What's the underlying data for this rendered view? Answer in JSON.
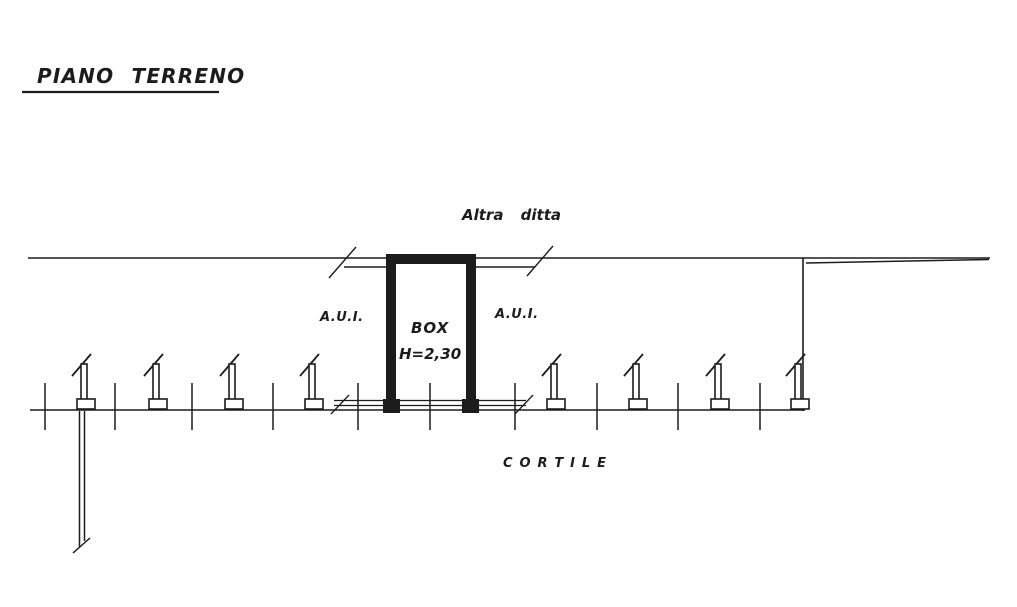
{
  "colors": {
    "ink": "#1c1c1c",
    "paper": "#ffffff"
  },
  "plan": {
    "title": "PIANO TERRENO",
    "labels": {
      "altra_ditta": "Altra ditta",
      "aui_left": "A.U.I.",
      "aui_right": "A.U.I.",
      "box": "BOX",
      "box_height": "H=2,30",
      "cortile": "C O R T I L E"
    }
  }
}
